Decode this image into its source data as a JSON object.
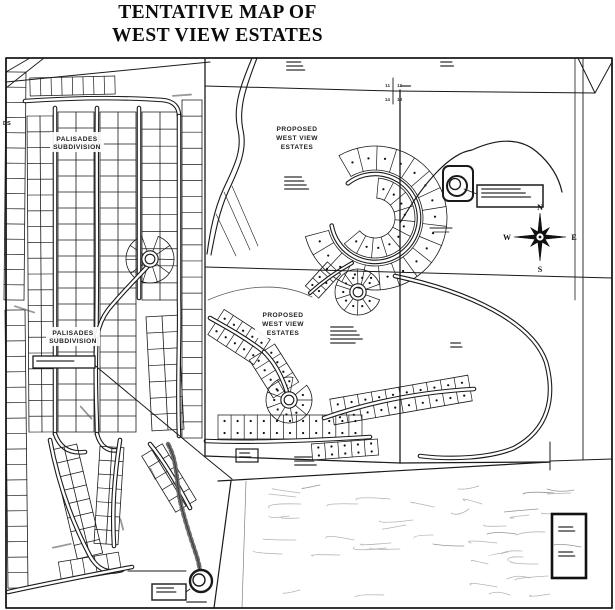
{
  "title": {
    "line1": "TENTATIVE MAP OF",
    "line2": "WEST VIEW ESTATES"
  },
  "labels": {
    "palisades_upper_1": "PALISADES",
    "palisades_upper_2": "SUBDIVISION",
    "palisades_lower_1": "PALISADES",
    "palisades_lower_2": "SUBDIVISION",
    "proposed_upper_1": "PROPOSED",
    "proposed_upper_2": "WEST VIEW",
    "proposed_upper_3": "ESTATES",
    "proposed_lower_1": "PROPOSED",
    "proposed_lower_2": "WEST VIEW",
    "proposed_lower_3": "ESTATES"
  },
  "compass": {
    "north": "N",
    "east": "E",
    "south": "S",
    "west": "W"
  },
  "section_corner": {
    "nw": "11",
    "ne": "12",
    "sw": "14",
    "se": "13"
  },
  "edge_text": "DS",
  "colors": {
    "ink": "#1a1a1a",
    "paper": "#ffffff",
    "faint_topo": "#adadad",
    "smudge": "#4a4a4a"
  }
}
